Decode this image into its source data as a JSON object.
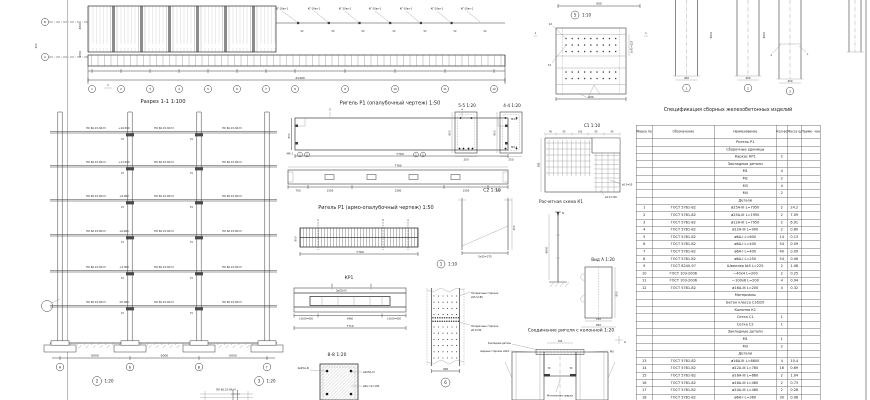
{
  "sheet": {
    "margin_dim_a": "4800",
    "margin_dim_b": "1800",
    "margin_dim_c": "300"
  },
  "plan": {
    "link_label": "КГ-10ап-1",
    "v_label": "У2",
    "row_axis_top": "Б",
    "row_axis_bottom": "А",
    "total_dim": "41400",
    "section_mark": "1",
    "grid_numbers": [
      "1",
      "2",
      "3",
      "4",
      "5",
      "6",
      "7",
      "8",
      "9",
      "10",
      "11",
      "12"
    ]
  },
  "section": {
    "caption": "Разрез 1-1  1:100",
    "slab_label": "ПК 60.15-8АтV",
    "elev": [
      "+16.500",
      "+13.200",
      "+9.900",
      "+6.600",
      "+3.300",
      "±0.000"
    ],
    "beam_mark": "Р1",
    "span_dim": "6000",
    "axis": [
      "А",
      "Б",
      "В",
      "Г"
    ],
    "detail2_num": "2",
    "detail3_num": "3",
    "detail_scale": "1:20",
    "bottom_fragment_label": "ПК 60.15-8АтV"
  },
  "rigel_form": {
    "caption": "Ригель Р1 (опалубочный чертеж) 1:50",
    "m42": "М4.2",
    "m41": "М4.1",
    "len": "7760",
    "h": "800",
    "plan_len": "7760",
    "chain": [
      "700",
      "1550",
      "3260",
      "1550",
      "700"
    ],
    "flag4": "4",
    "flag5": "5",
    "b1": "1",
    "b2": "2"
  },
  "rigel_armo": {
    "caption": "Ригель Р1 (армо-опалубочный чертеж) 1:50",
    "len": "7760",
    "h": "800",
    "f1": "1",
    "f2": "2"
  },
  "kr1": {
    "caption": "КР1",
    "f1": "1",
    "f2": "2",
    "bar": "2ø25А-III",
    "chain": [
      "13х50=650",
      "6460",
      "13х50=650"
    ],
    "total": "7710"
  },
  "sec88": {
    "caption": "8-8  1:20",
    "l1": "2ø25А-III",
    "r1": "2ø25А-III",
    "r2": "ø6А-I S=100"
  },
  "detail1": {
    "num": "1",
    "scale": "1:10",
    "lead1a": "Поперечные стержни",
    "lead1b": "2ø5 S=80",
    "lead2a": "Поперечные стержни",
    "lead2b": "ø6 S=80",
    "dim": "400",
    "bubble": "6"
  },
  "c2": {
    "caption": "С2  1:10",
    "dim": "5х55=275",
    "h_dim": "300"
  },
  "detail5": {
    "num": "5",
    "scale": "1:10",
    "top_dim": "600",
    "lead1": "12",
    "lead2": "13",
    "right_dim": "3х75=225",
    "bottom_dim": "600",
    "flag": "1"
  },
  "sec55": {
    "caption": "5-5  1:20",
    "h": "800",
    "w": "250"
  },
  "sec44": {
    "caption": "4-4  1:20",
    "h": "800",
    "w": "250"
  },
  "c1": {
    "caption": "С1  1:10",
    "top_chain": [
      "40",
      "90",
      "100",
      "90",
      "40"
    ],
    "left_dim": "360",
    "lead1": "ø5 S=50",
    "lead2": "ø4 S=100"
  },
  "scheme": {
    "caption": "Расчетная схема К1",
    "force": "N",
    "h_dim": "6600"
  },
  "viewA": {
    "caption": "Вид А  1:20",
    "h": "800",
    "d1": "230",
    "d2": "850"
  },
  "joint": {
    "caption": "Соединение ригеля с колонной 1:20",
    "mark": "А",
    "top_dim": "100",
    "gap": "30",
    "label1": "Закладная деталь",
    "label2": "сварные стержни 2ø16",
    "label3": "М5",
    "bottom_label": "Монтажная сварка"
  },
  "columns": {
    "dim_w": "400",
    "dim_h": "6600",
    "lead1": "2",
    "lead2": "1",
    "b": [
      "1",
      "2",
      "3"
    ]
  },
  "spec": {
    "title": "Спецификация сборных железобетонных изделий",
    "headers": [
      "Марка позиц.",
      "Обозначение",
      "Наименование",
      "Кол-во",
      "Масса ед., кг",
      "Приме- чание"
    ],
    "rows": [
      [
        "",
        "",
        "Ригель Р1",
        "",
        "",
        ""
      ],
      [
        "",
        "",
        "Сборочные единицы",
        "",
        "",
        ""
      ],
      [
        "",
        "",
        "Каркас КР1",
        "2",
        "",
        ""
      ],
      [
        "",
        "",
        "Закладные детали",
        "",
        "",
        ""
      ],
      [
        "",
        "",
        "М1",
        "4",
        "",
        ""
      ],
      [
        "",
        "",
        "М2",
        "2",
        "",
        ""
      ],
      [
        "",
        "",
        "М3",
        "4",
        "",
        ""
      ],
      [
        "",
        "",
        "М4",
        "2",
        "",
        ""
      ],
      [
        "",
        "",
        "Детали",
        "",
        "",
        ""
      ],
      [
        "1",
        "ГОСТ 5781-82",
        "ø25А-III L=7950",
        "2",
        "24.2",
        ""
      ],
      [
        "2",
        "ГОСТ 5781-82",
        "ø25А-III L=1950",
        "2",
        "7.09",
        ""
      ],
      [
        "3",
        "ГОСТ 5781-82",
        "ø12А-III L=7950",
        "2",
        "6.91",
        ""
      ],
      [
        "4",
        "ГОСТ 5781-82",
        "ø12А-III L=900",
        "2",
        "0.80",
        ""
      ],
      [
        "5",
        "ГОСТ 5781-82",
        "ø6А-I L=600",
        "14",
        "0.13",
        ""
      ],
      [
        "6",
        "ГОСТ 5781-82",
        "ø6А-I L=400",
        "54",
        "0.09",
        ""
      ],
      [
        "7",
        "ГОСТ 5781-82",
        "ø6А-I L=400",
        "40",
        "0.09",
        ""
      ],
      [
        "8",
        "ГОСТ 5781-82",
        "ø6А-I L=250",
        "54",
        "0.06",
        ""
      ],
      [
        "9",
        "ГОСТ 8240-97",
        "Швеллер №5 L=225",
        "2",
        "1.08",
        ""
      ],
      [
        "10",
        "ГОСТ 103-2006",
        "—40х4 L=200",
        "2",
        "0.25",
        ""
      ],
      [
        "11",
        "ГОСТ 103-2006",
        "—100х6 L=200",
        "4",
        "0.94",
        ""
      ],
      [
        "12",
        "ГОСТ 5781-82",
        "ø16А-III L=200",
        "4",
        "0.32",
        ""
      ],
      [
        "",
        "",
        "Материалы",
        "",
        "",
        ""
      ],
      [
        "",
        "",
        "Бетон класса С16/20",
        "",
        "",
        ""
      ],
      [
        "",
        "",
        "Колонна К1",
        "",
        "",
        ""
      ],
      [
        "",
        "",
        "Сетка С1",
        "1",
        "",
        ""
      ],
      [
        "",
        "",
        "Сетка С2",
        "1",
        "",
        ""
      ],
      [
        "",
        "",
        "Закладные детали",
        "",
        "",
        ""
      ],
      [
        "",
        "",
        "М1",
        "1",
        "",
        ""
      ],
      [
        "",
        "",
        "М3",
        "2",
        "",
        ""
      ],
      [
        "",
        "",
        "Детали",
        "",
        "",
        ""
      ],
      [
        "13",
        "ГОСТ 5781-82",
        "ø16А-III L=6600",
        "4",
        "10.4",
        ""
      ],
      [
        "14",
        "ГОСТ 5781-82",
        "ø12А-III L=780",
        "16",
        "0.69",
        ""
      ],
      [
        "15",
        "ГОСТ 5781-82",
        "ø16А-III L=660",
        "2",
        "1.04",
        ""
      ],
      [
        "16",
        "ГОСТ 5781-82",
        "ø16А-III L=460",
        "2",
        "0.73",
        ""
      ],
      [
        "17",
        "ГОСТ 5781-82",
        "ø10А-III L=460",
        "2",
        "0.28",
        ""
      ],
      [
        "18",
        "ГОСТ 5781-82",
        "ø6А-I L=360",
        "30",
        "0.08",
        ""
      ],
      [
        "19",
        "ГОСТ 5781-82",
        "ø6А-I L=180",
        "16",
        "0.04",
        ""
      ],
      [
        "",
        "",
        "Материалы",
        "",
        "",
        ""
      ]
    ]
  }
}
